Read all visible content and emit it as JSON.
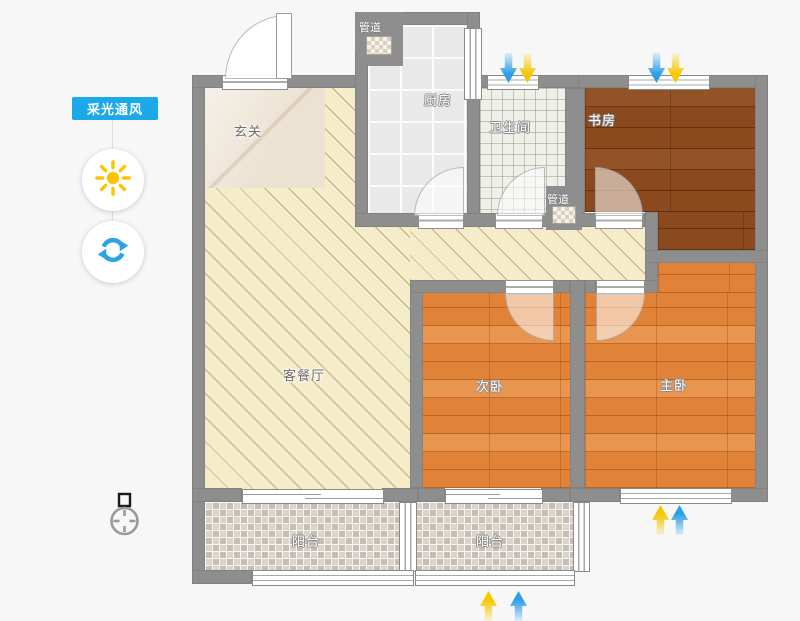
{
  "legend": {
    "badge_label": "采光通风"
  },
  "icons": {
    "sun": "sun-icon",
    "refresh": "refresh-icon",
    "compass": "compass-north-icon",
    "arrow_down_blue": "ventilation-arrow",
    "arrow_down_yellow": "daylight-arrow"
  },
  "colors": {
    "accent_blue": "#1BA9E9",
    "sun_yellow": "#FFC400",
    "refresh_blue": "#2AA3E8",
    "arrow_blue": "#2E9FE6",
    "arrow_yellow": "#F6C700",
    "wall_gray": "#8E8E8E",
    "living_cream": "#F5ECCA",
    "bedroom_wood": "#E08338",
    "study_wood": "#8A4A1E"
  },
  "floorplan": {
    "rooms": {
      "entry": {
        "label": "玄关"
      },
      "living_dining": {
        "label": "客餐厅"
      },
      "kitchen": {
        "label": "厨房"
      },
      "bathroom": {
        "label": "卫生间"
      },
      "study": {
        "label": "书房"
      },
      "second_bedroom": {
        "label": "次卧"
      },
      "master_bedroom": {
        "label": "主卧"
      },
      "balcony_left": {
        "label": "阳台"
      },
      "balcony_right": {
        "label": "阳台"
      }
    },
    "ducts": {
      "kitchen_duct": "管道",
      "hall_duct": "管道"
    }
  }
}
